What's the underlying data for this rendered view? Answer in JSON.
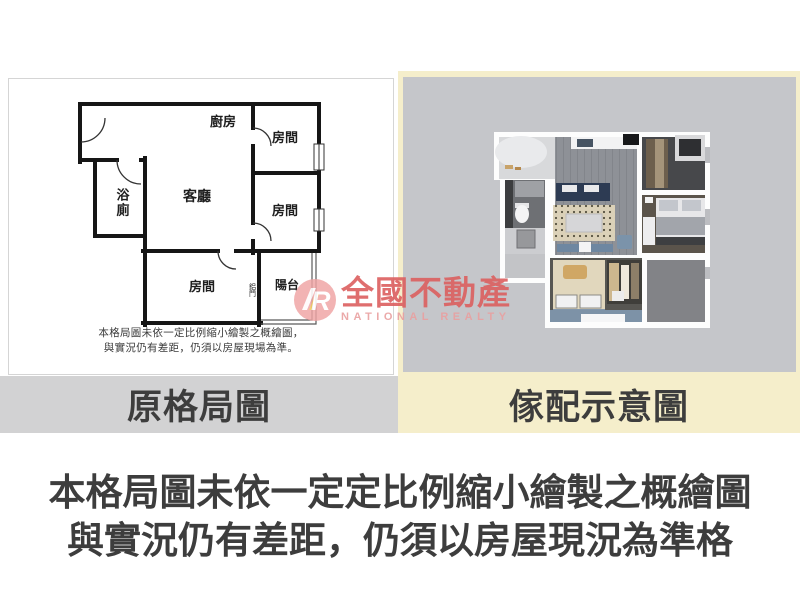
{
  "left_panel": {
    "caption": "原格局圖",
    "rooms": {
      "kitchen": "廚房",
      "bedroom_top_right": "房間",
      "bathroom": "浴廁",
      "living_room": "客廳",
      "bedroom_mid_right": "房間",
      "bedroom_bottom": "房間",
      "balcony": "陽台",
      "sliding_door": "鋁門"
    },
    "disclaimer": {
      "line1": "本格局圖未依一定比例縮小繪製之概繪圖，",
      "line2": "與實況仍有差距，仍須以房屋現場為準。"
    }
  },
  "right_panel": {
    "caption": "傢配示意圖"
  },
  "watermark": {
    "logo_letter": "R",
    "brand_zh": "全國不動產",
    "brand_en": "NATIONAL REALTY"
  },
  "footer": {
    "line1": "本格局圖未依一定定比例縮小繪製之概繪圖",
    "line2": "與實況仍有差距，仍須以房屋現況為準格"
  },
  "colors": {
    "cream": "#f5eecb",
    "caption_band_gray": "#d2d2d3",
    "render_background": "#c5c6ca",
    "text_dark": "#3d3d3d",
    "watermark_red": "#dc5f5f",
    "watermark_pink": "#e9a0a0",
    "plan_wall": "#161616"
  }
}
